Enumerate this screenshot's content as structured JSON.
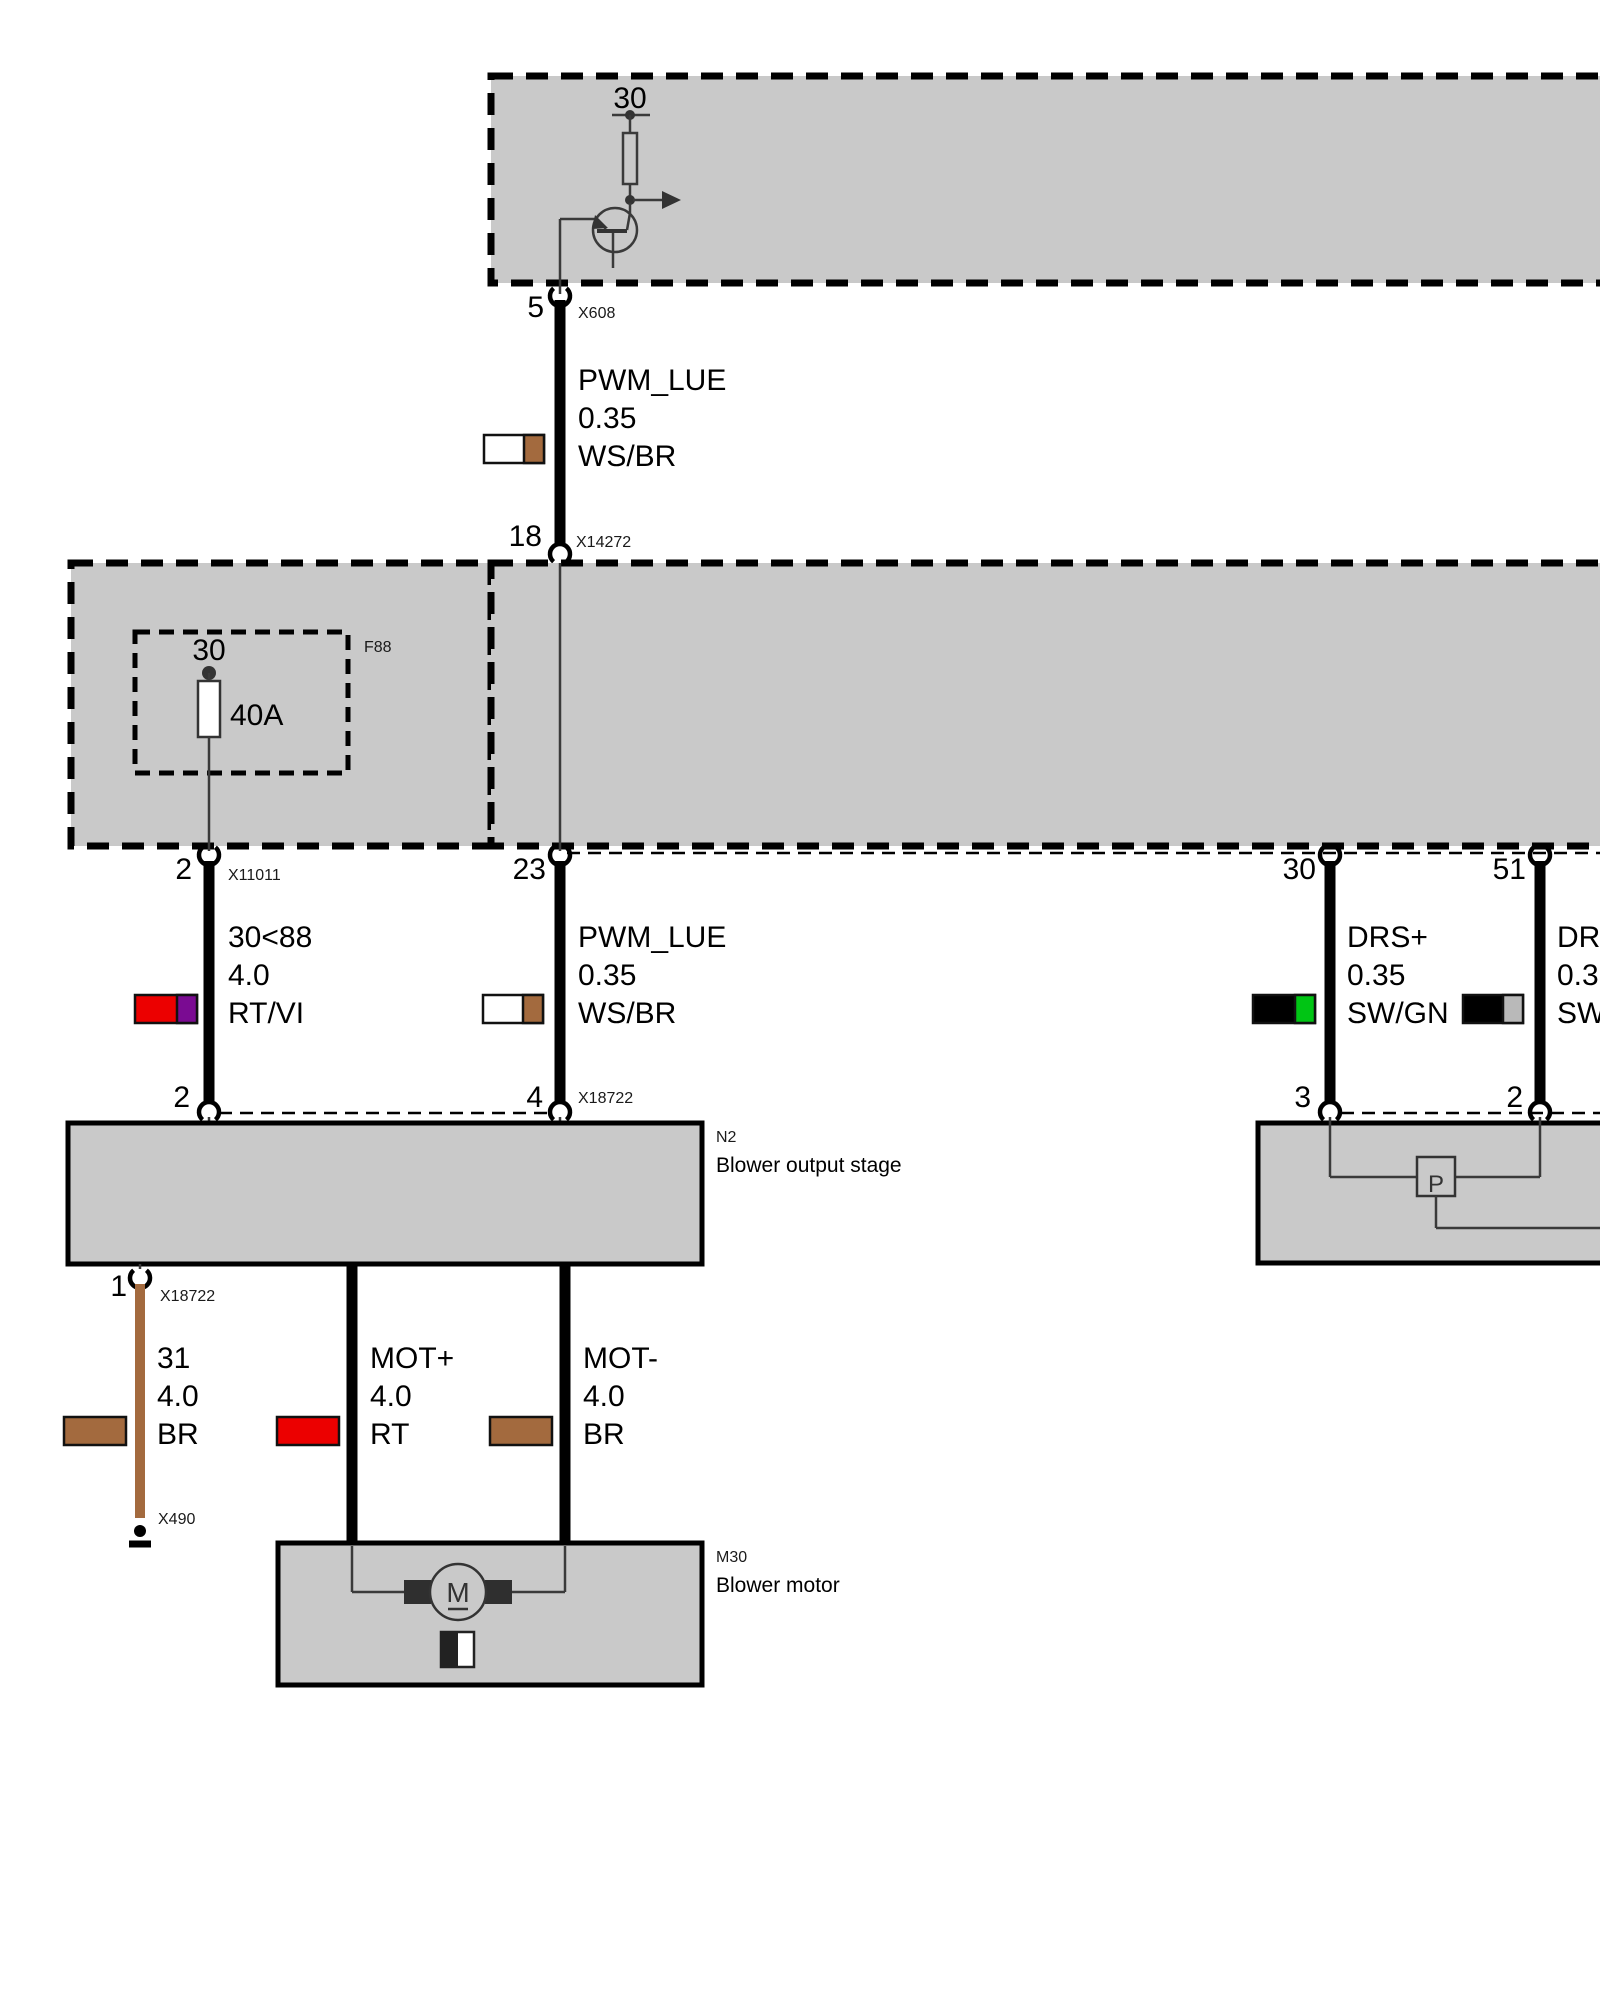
{
  "colors": {
    "red": "#ec0000",
    "violet": "#7a0b92",
    "brown": "#a36a3e",
    "green": "#00c514",
    "gray": "#b9b9b9",
    "white": "#ffffff",
    "black": "#000000",
    "box_fill": "#c9c9c9"
  },
  "top_module": {
    "terminal": "30"
  },
  "junction": {
    "fuse_terminal": "30",
    "fuse_rating": "40A",
    "fuse_id": "F88"
  },
  "w1": {
    "pin_top": "5",
    "conn_top": "X608",
    "signal": "PWM_LUE",
    "size": "0.35",
    "code": "WS/BR",
    "pin_bottom": "18",
    "conn_bottom": "X14272"
  },
  "w2": {
    "pin_top": "2",
    "conn_top": "X11011",
    "signal": "30<88",
    "size": "4.0",
    "code": "RT/VI",
    "pin_bottom": "2"
  },
  "w3": {
    "pin_top": "23",
    "signal": "PWM_LUE",
    "size": "0.35",
    "code": "WS/BR",
    "pin_bottom": "4",
    "conn_bottom": "X18722"
  },
  "w4": {
    "pin_top": "30",
    "signal": "DRS+",
    "size": "0.35",
    "code": "SW/GN",
    "pin_bottom": "3"
  },
  "w5": {
    "pin_top": "51",
    "signal": "DRS",
    "size": "0.35",
    "code": "SW/",
    "pin_bottom": "2"
  },
  "w6": {
    "pin_top": "1",
    "conn_top": "X18722",
    "signal": "31",
    "size": "4.0",
    "code": "BR",
    "ground_conn": "X490"
  },
  "w7": {
    "signal": "MOT+",
    "size": "4.0",
    "code": "RT"
  },
  "w8": {
    "signal": "MOT-",
    "size": "4.0",
    "code": "BR"
  },
  "n2": {
    "code": "N2",
    "name": "Blower output stage"
  },
  "m30": {
    "code": "M30",
    "name": "Blower motor",
    "motor_symbol": "M"
  },
  "right_ecu": {
    "pump_symbol": "P"
  }
}
